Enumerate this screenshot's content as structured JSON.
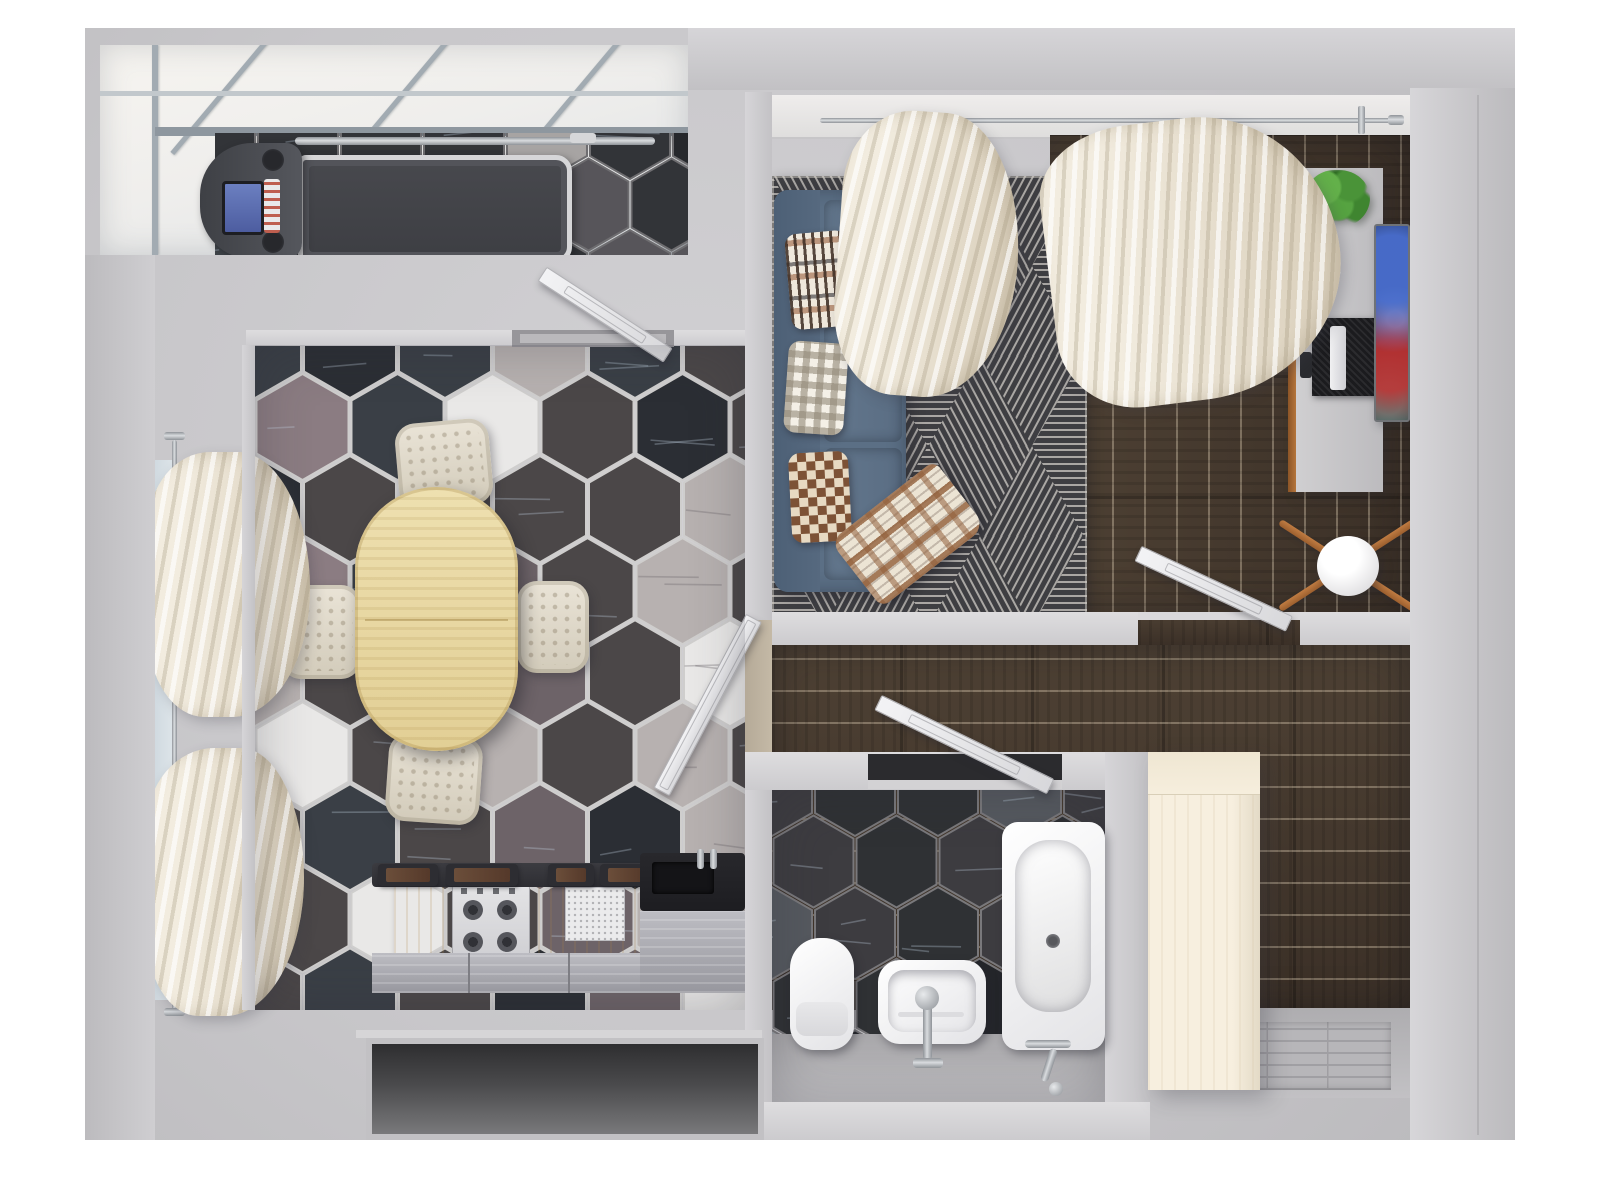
{
  "scene": {
    "type": "apartment-floor-plan-3d-render",
    "view": "top-down",
    "rooms": [
      "balcony-gym",
      "kitchen-dining",
      "living-room",
      "hallway",
      "bathroom",
      "entry"
    ]
  },
  "palette": {
    "bg": "#ffffff",
    "ground": "#c8c7ca",
    "wallLight": "#d8d7da",
    "wallMid": "#c3c2c5",
    "woodFloor": "#46392c",
    "tableWood": "#e8d8a2",
    "counterWood": "#e6c98f",
    "cream": "#e9e3d5",
    "curtain": "#efe9dd",
    "sofa": "#5b6f85",
    "rugBase": "#3e3e42",
    "rugLine": "#c9c6c0",
    "fixtureWhite": "#f2f2f4",
    "chrome": "#aeb2b6",
    "plantGreen": "#4a9338",
    "trimWood": "#a96a33",
    "wardrobe": "#f6eede",
    "glass": "#dfe3e6",
    "tvScreenDark": "#10131a"
  },
  "floors": {
    "dining": {
      "w": 490,
      "h": 665,
      "hex": 46,
      "seed": 7,
      "grout": "#cfcecd",
      "palette": [
        [
          "#4b4748",
          34
        ],
        [
          "#3a3f46",
          14
        ],
        [
          "#2b2e34",
          12
        ],
        [
          "#8b7c82",
          11
        ],
        [
          "#b7b1b0",
          10
        ],
        [
          "#e9e8e7",
          10
        ],
        [
          "#6d6368",
          9
        ]
      ]
    },
    "bath": {
      "w": 333,
      "h": 246,
      "hex": 40,
      "seed": 3,
      "grout": "#79787b",
      "palette": [
        [
          "#2f3134",
          38
        ],
        [
          "#3d3c40",
          22
        ],
        [
          "#24262a",
          16
        ],
        [
          "#9da1a6",
          12
        ],
        [
          "#55595f",
          12
        ]
      ]
    },
    "balcony": {
      "w": 473,
      "h": 124,
      "hex": 40,
      "seed": 11,
      "grout": "#6e6d70",
      "palette": [
        [
          "#323438",
          42
        ],
        [
          "#3f4449",
          24
        ],
        [
          "#26282c",
          16
        ],
        [
          "#a7a4a3",
          9
        ],
        [
          "#57555a",
          9
        ]
      ]
    }
  },
  "rug": {
    "w": 315,
    "h": 440,
    "side": 104,
    "seed": 5,
    "bg": "#3e3e42",
    "line": "#c9c6c0",
    "spacing": 7
  },
  "furniture": {
    "balcony-gym": [
      "treadmill"
    ],
    "kitchen-dining": [
      "oval-dining-table",
      "dining-chair-top",
      "dining-chair-right",
      "dining-chair-bottom",
      "dining-chair-left",
      "kitchen-counter",
      "gas-stove",
      "kitchen-sink",
      "window-curtains"
    ],
    "living-room": [
      "corner-sofa",
      "pillow-ethnic",
      "pillow-gingham",
      "pillow-checker",
      "plaid-blanket",
      "geometric-rug",
      "tv-console",
      "tv",
      "potted-plant",
      "floor-lamp",
      "sheer-curtains"
    ],
    "bathroom": [
      "toilet",
      "washbasin",
      "bathtub"
    ],
    "entry": [
      "wardrobe",
      "entry-mat"
    ]
  }
}
